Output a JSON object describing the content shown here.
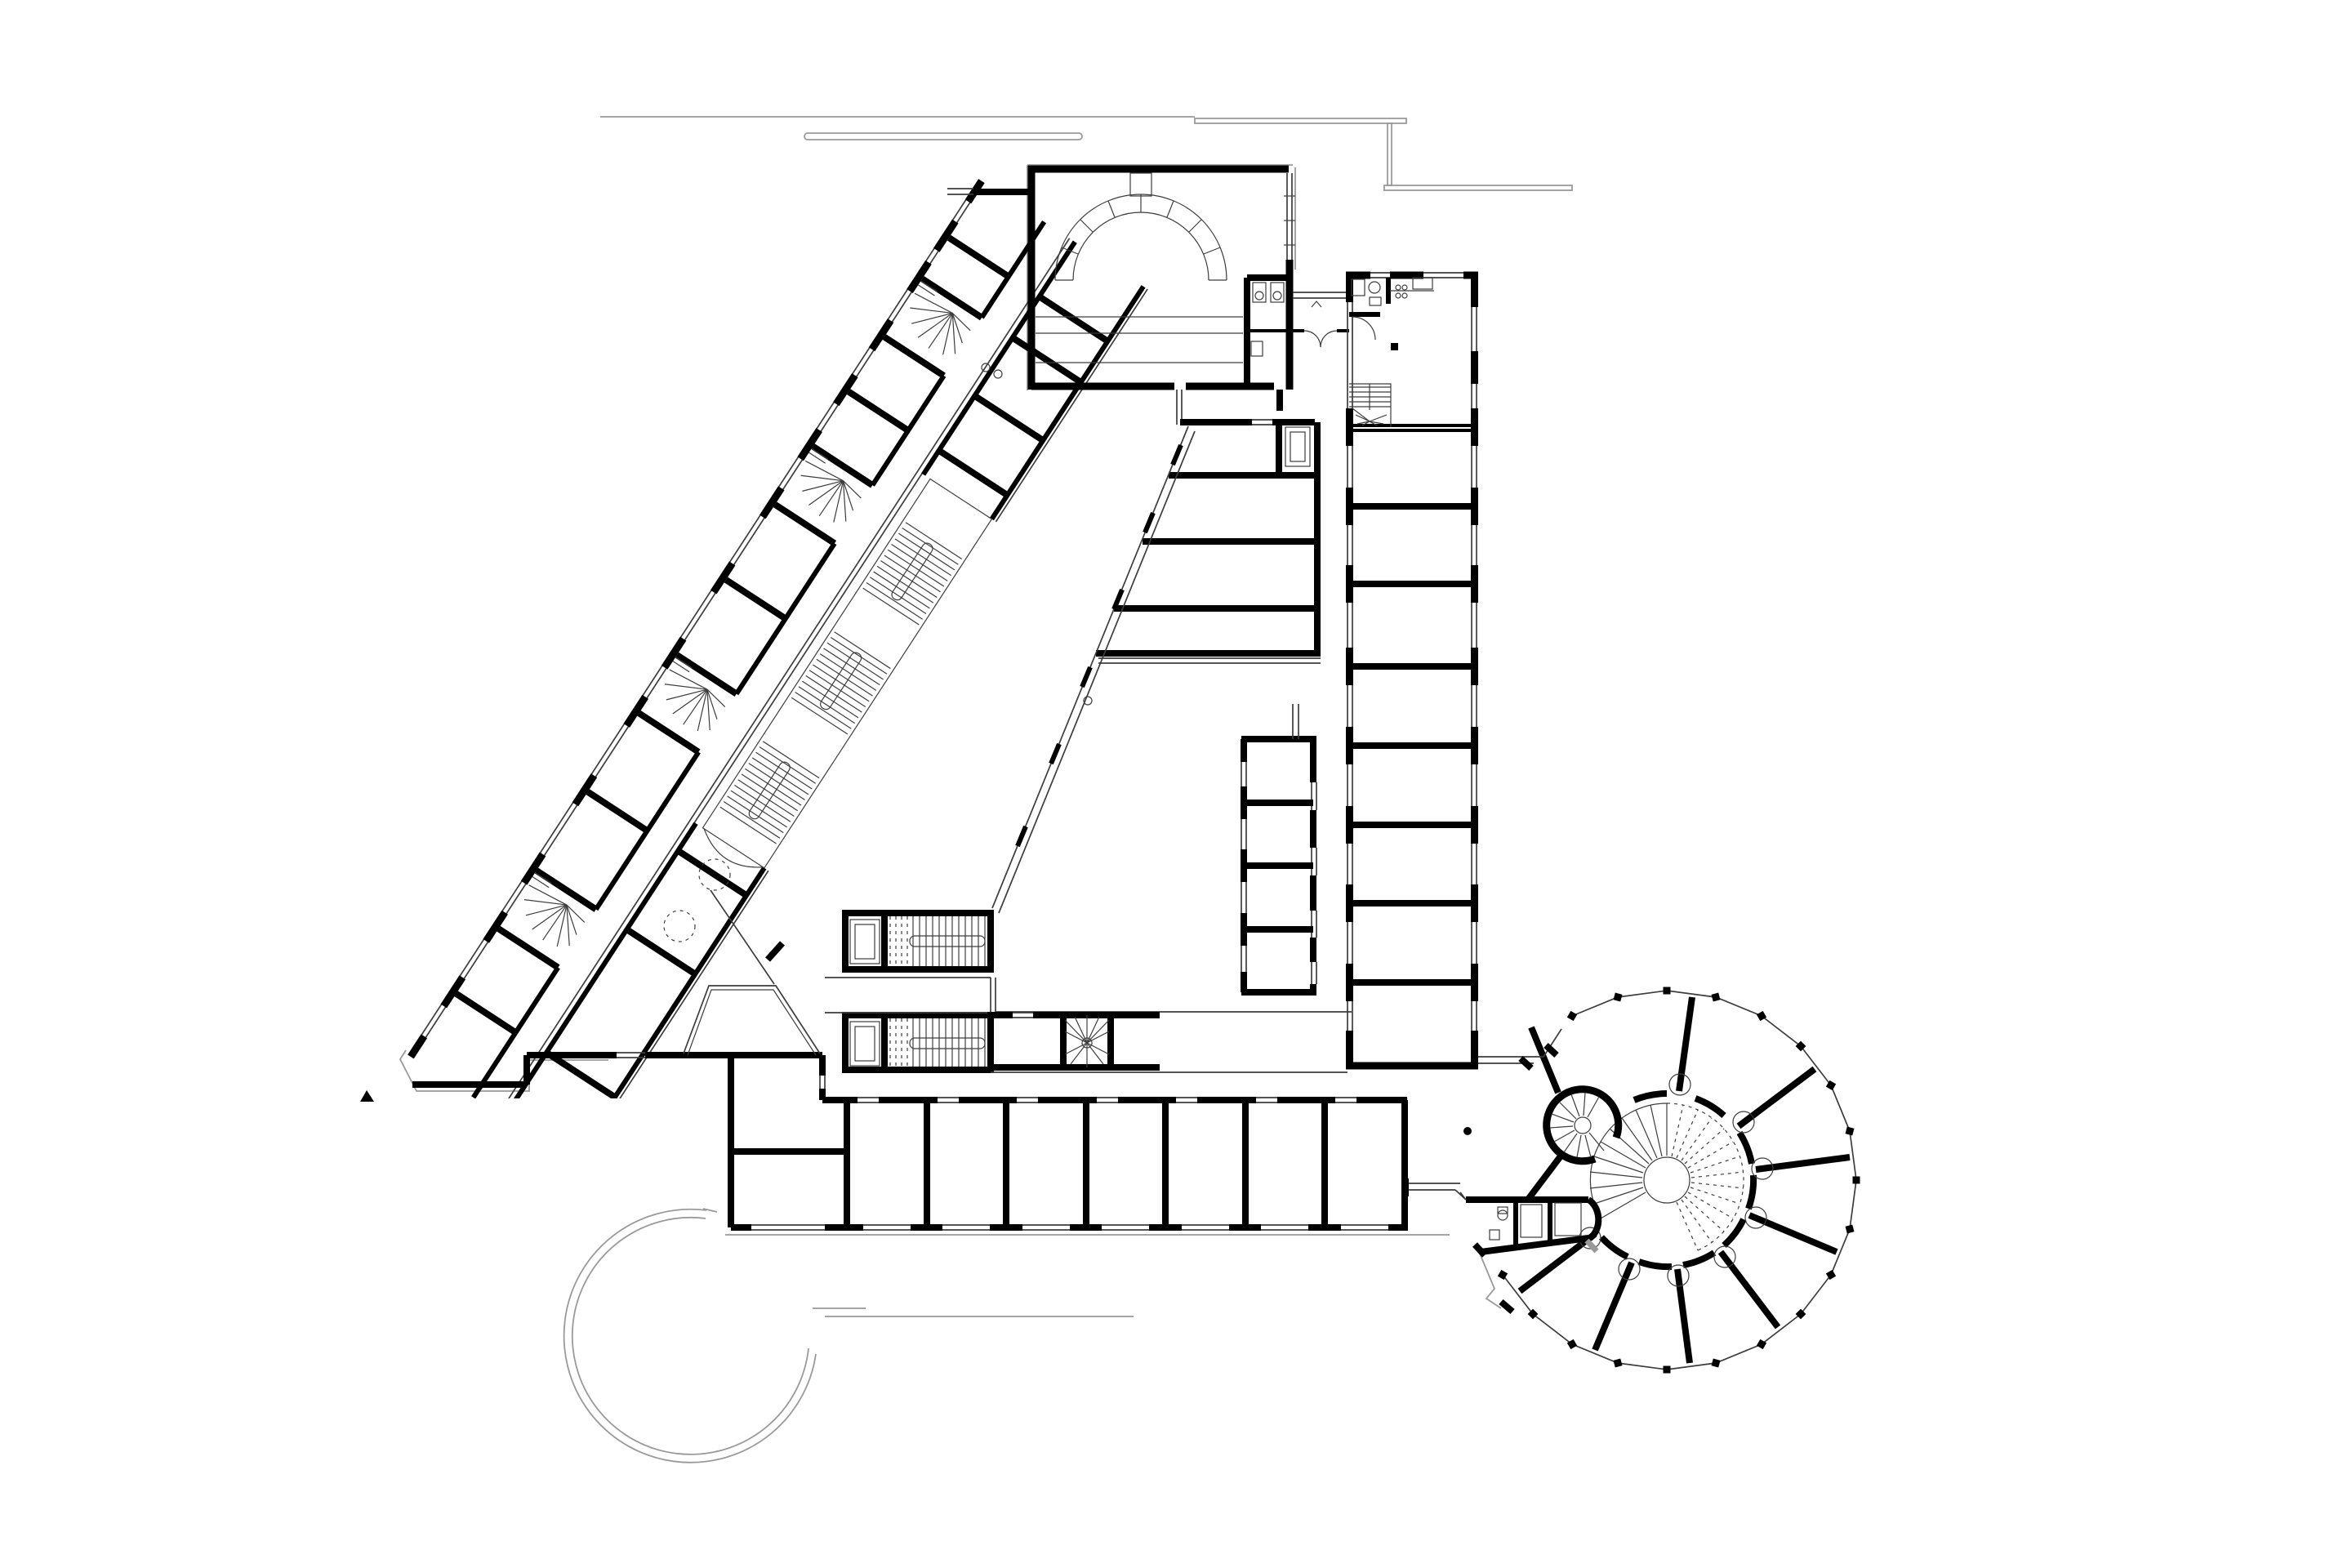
{
  "title": "Architectural floor plan — school building with diagonal wing, lecture hall and rotunda",
  "drawing": {
    "type": "architectural-floor-plan",
    "style": "black line work on white background",
    "annotations_text": "none"
  },
  "colors": {
    "bg": "#ffffff",
    "wall": "#000000",
    "line": "#3d3d3d",
    "site": "#9a9a9a"
  },
  "plan": {
    "lecture_hall": {
      "stage_arch_segments": 8,
      "floor_steps": 3
    },
    "diagonal_wing": {
      "room_dividers": 13,
      "winder_stairs": 4,
      "long_stair_flights": 3,
      "dashed_circles": 2
    },
    "east_wing": {
      "rooms": 8,
      "has_kitchen": true,
      "has_u_stair": true
    },
    "south_row": {
      "rooms": 8
    },
    "middle_block": {
      "rooms": 5,
      "strip_rooms": 4
    },
    "entrance": {
      "stair_cores": 2,
      "elevators": 2,
      "fan_stair": 1
    },
    "rotunda": {
      "radial_walls": 8,
      "perimeter_columns": 19,
      "central_spiral_stair": 1,
      "drum_spiral_stair": 1,
      "wc_block": 1
    }
  }
}
